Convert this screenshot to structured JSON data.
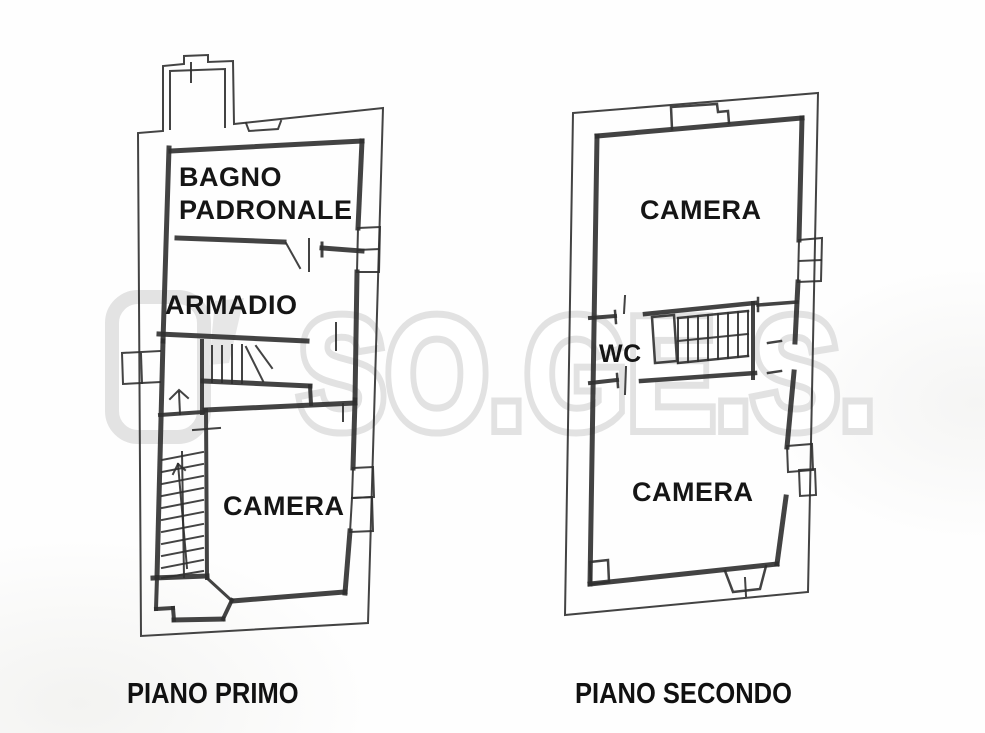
{
  "document": {
    "type": "scanned-floorplan",
    "watermark": {
      "text": "SO.GE.S."
    },
    "colors": {
      "background": "#fefefe",
      "line": "#2f2f2f",
      "watermark": "#e2e2e2",
      "label_text": "#151515"
    }
  },
  "plans": {
    "primo": {
      "caption": "PIANO PRIMO",
      "rooms": {
        "bagno_line1": "BAGNO",
        "bagno_line2": "PADRONALE",
        "armadio": "ARMADIO",
        "camera": "CAMERA"
      }
    },
    "secondo": {
      "caption": "PIANO SECONDO",
      "rooms": {
        "camera_top": "CAMERA",
        "wc": "WC",
        "camera_bottom": "CAMERA"
      }
    }
  }
}
